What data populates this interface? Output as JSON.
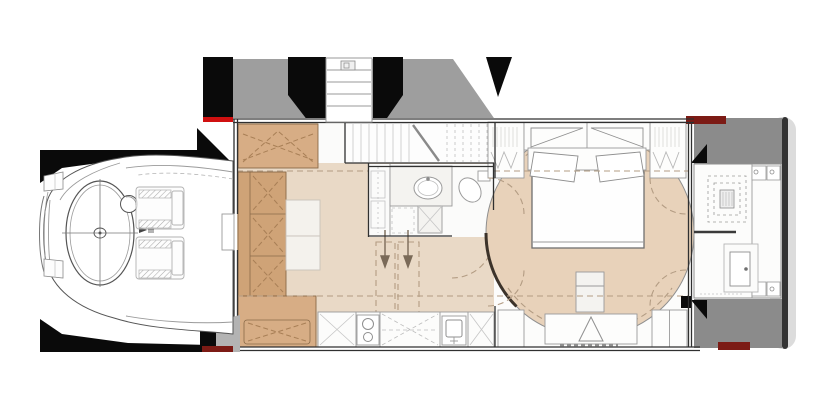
{
  "image": {
    "kind": "architectural-floor-plan",
    "canvas": {
      "width": 828,
      "height": 411
    }
  },
  "palette": {
    "background": "#ffffff",
    "floor": "#e9d9c6",
    "turntable": "#e8d2ba",
    "wood": "#d7ad85",
    "wood-dark": "#cfa377",
    "wood-border": "#8a6a48",
    "wood-line": "#a87f56",
    "line": "#4a4a4a",
    "line-light": "#9a9a9a",
    "wall": "#303030",
    "dash": "#b39c83",
    "gray-slide": "#9e9e9e",
    "gray-rear": "#8b8b8b",
    "gray-soft": "#b3b3b3",
    "black": "#0a0a0a",
    "red": "#d01010",
    "maroon": "#7c1b15",
    "fixture": "#f4f3f0"
  },
  "components": [
    "truck-cab",
    "driver-seat",
    "passenger-seat",
    "engine-turntable",
    "entry-steps",
    "interior-staircase",
    "overhead-cabinet",
    "sofa",
    "dinette-table",
    "storage-bench",
    "kitchen-counter",
    "stove",
    "kitchen-sink",
    "bathroom",
    "bathroom-sink",
    "toilet",
    "shower",
    "rotating-floor-circle",
    "double-bed",
    "pillows",
    "wardrobe-left",
    "wardrobe-right",
    "foot-bench",
    "tv-cabinet",
    "rear-room",
    "roof-hatch",
    "rear-door",
    "slide-out-shadows",
    "down-arrows"
  ]
}
